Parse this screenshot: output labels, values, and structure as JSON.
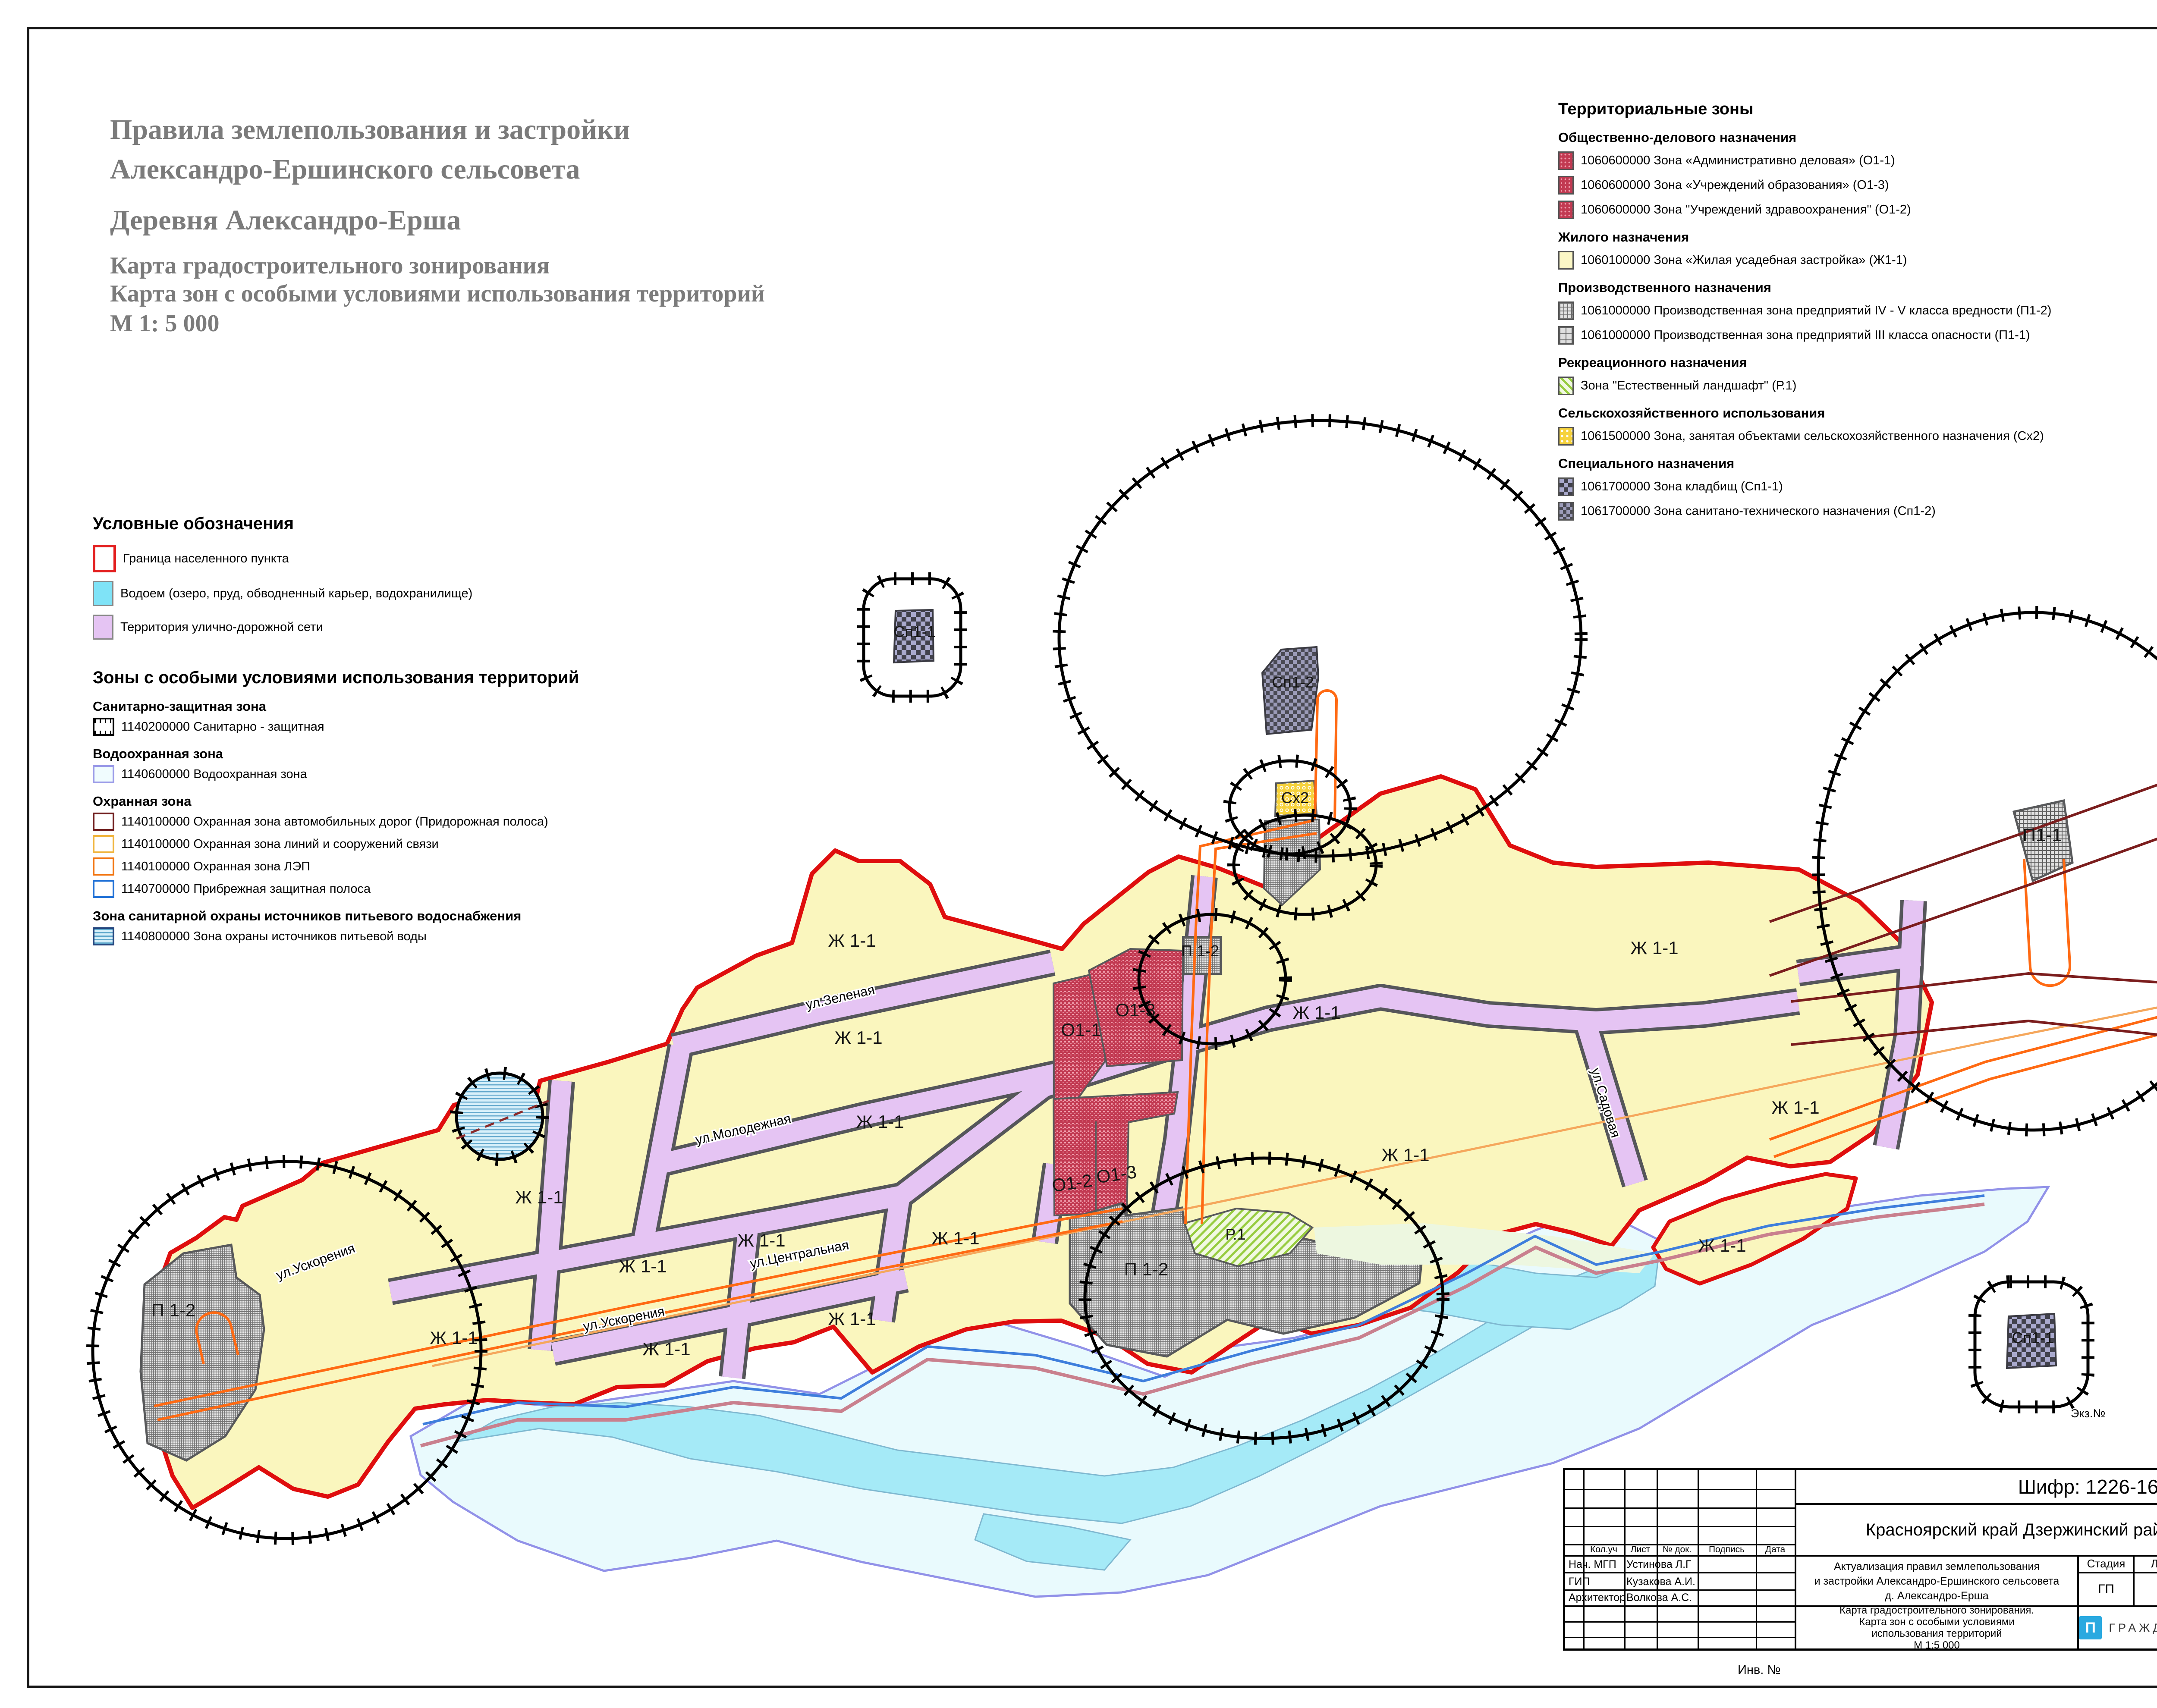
{
  "page": {
    "title_line1": "Правила землепользования и застройки",
    "title_line2": "Александро-Ершинского сельсовета",
    "title_line3": "Деревня Александро-Ерша",
    "title_line4": "Карта градостроительного зонирования",
    "title_line5": "Карта зон с особыми условиями использования территорий",
    "title_line6": "М 1: 5 000",
    "ekz": "Экз.№",
    "inv": "Инв. №"
  },
  "legend_territorial": {
    "title": "Территориальные зоны",
    "groups": [
      {
        "heading": "Общественно-делового назначения",
        "items": [
          {
            "label": "1060600000 Зона «Административно деловая» (О1-1)"
          },
          {
            "label": "1060600000 Зона «Учреждений образования» (О1-3)"
          },
          {
            "label": "1060600000 Зона \"Учреждений здравоохранения\" (О1-2)"
          }
        ]
      },
      {
        "heading": "Жилого назначения",
        "items": [
          {
            "label": "1060100000 Зона «Жилая усадебная застройка» (Ж1-1)"
          }
        ]
      },
      {
        "heading": "Производственного назначения",
        "items": [
          {
            "label": "1061000000 Производственная зона предприятий IV - V класса вредности (П1-2)"
          },
          {
            "label": "1061000000 Производственная зона предприятий III класса опасности (П1-1)"
          }
        ]
      },
      {
        "heading": "Рекреационного назначения",
        "items": [
          {
            "label": "Зона \"Естественный ландшафт\" (Р.1)"
          }
        ]
      },
      {
        "heading": "Сельскохозяйственного использования",
        "items": [
          {
            "label": "1061500000 Зона, занятая объектами сельскохозяйственного назначения (Сх2)"
          }
        ]
      },
      {
        "heading": "Специального назначения",
        "items": [
          {
            "label": "1061700000 Зона кладбищ (Сп1-1)"
          },
          {
            "label": "1061700000 Зона санитано-технического назначения (Сп1-2)"
          }
        ]
      }
    ]
  },
  "legend_symbols": {
    "title": "Условные обозначения",
    "items": [
      {
        "label": "Граница населенного пункта"
      },
      {
        "label": "Водоем (озеро, пруд, обводненный карьер, водохранилище)"
      },
      {
        "label": "Территория улично-дорожной сети"
      }
    ]
  },
  "legend_special": {
    "title": "Зоны с особыми условиями использования территорий",
    "groups": [
      {
        "heading": "Санитарно-защитная зона",
        "items": [
          {
            "label": "1140200000 Санитарно - защитная"
          }
        ]
      },
      {
        "heading": "Водоохранная зона",
        "items": [
          {
            "label": "1140600000 Водоохранная зона"
          }
        ]
      },
      {
        "heading": "Охранная зона",
        "items": [
          {
            "label": "1140100000 Охранная зона автомобильных дорог (Придорожная полоса)"
          },
          {
            "label": "1140100000 Охранная зона линий и сооружений связи"
          },
          {
            "label": "1140100000 Охранная зона ЛЭП"
          },
          {
            "label": "1140700000 Прибрежная защитная полоса"
          }
        ]
      },
      {
        "heading": "Зона санитарной охраны источников питьевого водоснабжения",
        "items": [
          {
            "label": "1140800000 Зона охраны источников питьевой воды"
          }
        ]
      }
    ]
  },
  "map": {
    "zone_labels": [
      {
        "text": "Ж 1-1"
      },
      {
        "text": "Ж 1-1"
      },
      {
        "text": "Ж 1-1"
      },
      {
        "text": "Ж 1-1"
      },
      {
        "text": "Ж 1-1"
      },
      {
        "text": "Ж 1-1"
      },
      {
        "text": "Ж 1-1"
      },
      {
        "text": "Ж 1-1"
      },
      {
        "text": "Ж 1-1"
      },
      {
        "text": "Ж 1-1"
      },
      {
        "text": "Ж 1-1"
      },
      {
        "text": "Ж 1-1"
      },
      {
        "text": "Ж 1-1"
      },
      {
        "text": "Ж 1-1"
      },
      {
        "text": "Ж 1-1"
      },
      {
        "text": "О1-1"
      },
      {
        "text": "О1-3"
      },
      {
        "text": "О1-2"
      },
      {
        "text": "О1-3"
      },
      {
        "text": "П 1-2"
      },
      {
        "text": "П 1-2"
      },
      {
        "text": "П 1-2"
      },
      {
        "text": "П1-1"
      },
      {
        "text": "Сп1-2"
      },
      {
        "text": "Сх2"
      },
      {
        "text": "Сп1-1"
      },
      {
        "text": "Сп1-1"
      },
      {
        "text": "Р.1"
      }
    ],
    "street_labels": [
      {
        "text": "ул.Зеленая"
      },
      {
        "text": "ул.Молодежная"
      },
      {
        "text": "ул.Центральная"
      },
      {
        "text": "ул.Ускорения"
      },
      {
        "text": "ул.Ускорения"
      },
      {
        "text": "ул.Садовая"
      }
    ]
  },
  "titleblock": {
    "shifr": "Шифр: 1226-16.06",
    "region": "Красноярский край Дзержинский район",
    "project": [
      "Актуализация правил землепользования",
      "и застройки Александро-Ершинского сельсовета",
      "д. Александро-Ерша"
    ],
    "doc": [
      "Карта градостроительного зонирования.",
      "Карта зон с особыми условиями",
      "использования территорий",
      "М 1:5 000"
    ],
    "headers": {
      "koluch": "Кол.уч",
      "list": "Лист",
      "ndok": "№ док.",
      "podpis": "Подпись",
      "data": "Дата",
      "stadia": "Стадия",
      "list2": "Лист",
      "listov": "Листов"
    },
    "values": {
      "stadia": "ГП",
      "list": "3",
      "listov": "6"
    },
    "roles": [
      {
        "role": "Нач. МГП",
        "name": "Устинова Л.Г"
      },
      {
        "role": "ГИП",
        "name": "Кузакова А.И."
      },
      {
        "role": "Архитектор",
        "name": "Волкова А.С."
      }
    ],
    "company": "ГРАЖДАНПРОЕКТ",
    "logo_glyph": "П"
  }
}
